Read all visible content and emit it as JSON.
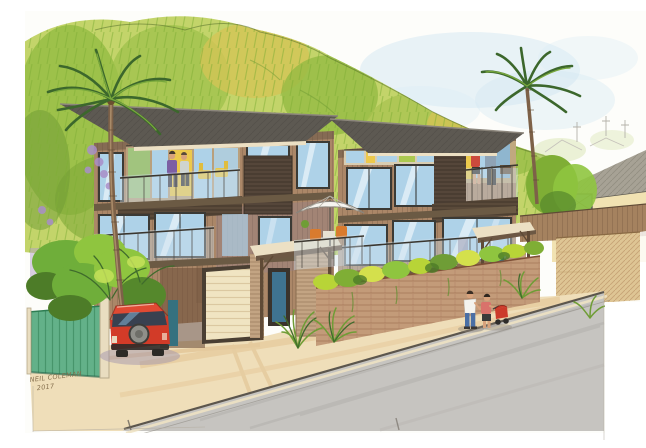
{
  "artwork": {
    "medium": "pen and watercolor architectural rendering",
    "subject": "Modern three-storey timber apartment complex on a hillside street",
    "signature": {
      "name": "NEIL COLEMAN",
      "year": "2017"
    },
    "scene_objects": [
      "green hillside backdrop",
      "two palm trees",
      "three-storey timber apartments with glass balconies",
      "roof terrace with two figures",
      "balcony with two figures and yellow chairs",
      "white patio umbrella with orange chairs",
      "timber entrance canopies and slatted screens",
      "cream garage door",
      "green timber fence",
      "red hatchback car with rear spare wheel",
      "brick planter wall with bright shrubs",
      "ornamental grasses",
      "couple pushing a red stroller on the footpath",
      "neighbouring cream house with grey roof",
      "street with kerb and gutter"
    ]
  },
  "palette": {
    "paper": "#fdfdfa",
    "sky": "#cfe4f1",
    "hill_light": "#c3d46a",
    "hill_mid": "#94bb42",
    "hill_dark": "#6d9a33",
    "roof": "#5d5952",
    "timber": "#ab8768",
    "timber_dark": "#6f523c",
    "glass": "#aed2e8",
    "interior_yellow": "#ecc94c",
    "garage": "#f0e4c2",
    "door_teal": "#35717f",
    "brick": "#c39b79",
    "plant_bright": "#b8d437",
    "fence": "#63b189",
    "driveway": "#efdeb9",
    "road": "#c6c4c0",
    "car_red": "#d23b28",
    "umbrella_white": "#f6f4ef",
    "house_wall": "#f1e2b2",
    "shadow_purple": "#9c8fae"
  }
}
